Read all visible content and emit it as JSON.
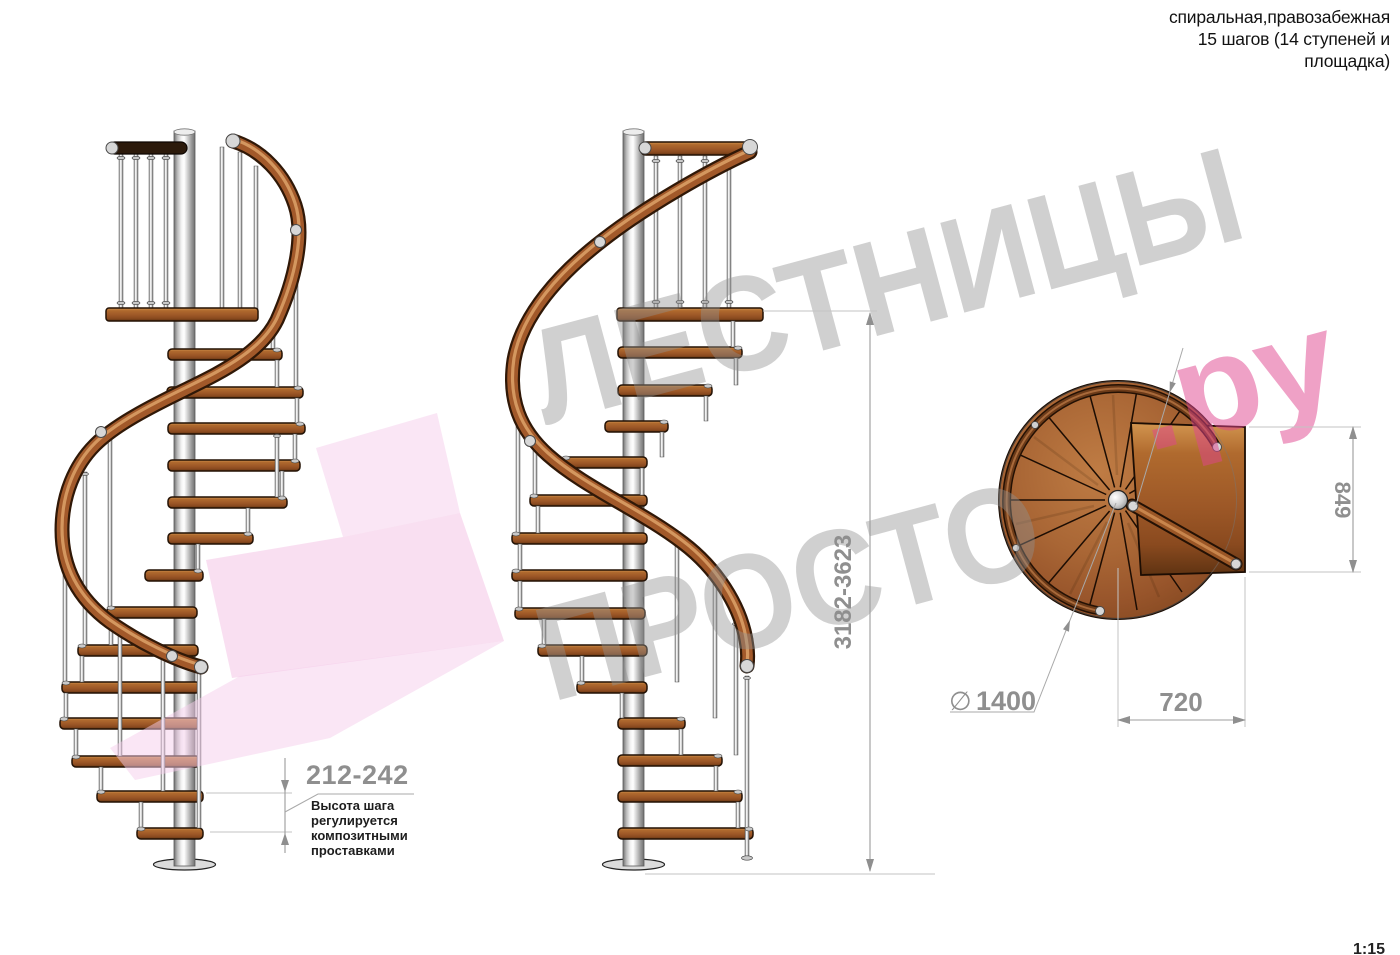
{
  "title_block": {
    "lines": [
      "спиральная,правозабежная",
      "15 шагов (14 ступеней и",
      "площадка)"
    ]
  },
  "watermark": {
    "word1": "ЛЕСТНИЦЫ",
    "word2": "ПРОСТО",
    "word2_suffix": ".ру"
  },
  "dimensions": {
    "step_height": {
      "value": "212-242",
      "note": [
        "Высота шага",
        "регулируется",
        "композитными",
        "проставками"
      ]
    },
    "total_height": {
      "value": "3182-3623"
    },
    "platform_depth": {
      "value": "849"
    },
    "landing_width": {
      "value": "720"
    },
    "diameter": {
      "symbol": "∅",
      "value": "1400"
    }
  },
  "scale": "1:15",
  "colors": {
    "wood": "#a2592a",
    "wood_dark": "#6b3a18",
    "metal": "#d7d7d7",
    "dimension_gray": "#8f8f8f",
    "watermark_gray": "#919191",
    "watermark_pink": "#e0458f",
    "logo_pink": "#f3bfe4"
  }
}
